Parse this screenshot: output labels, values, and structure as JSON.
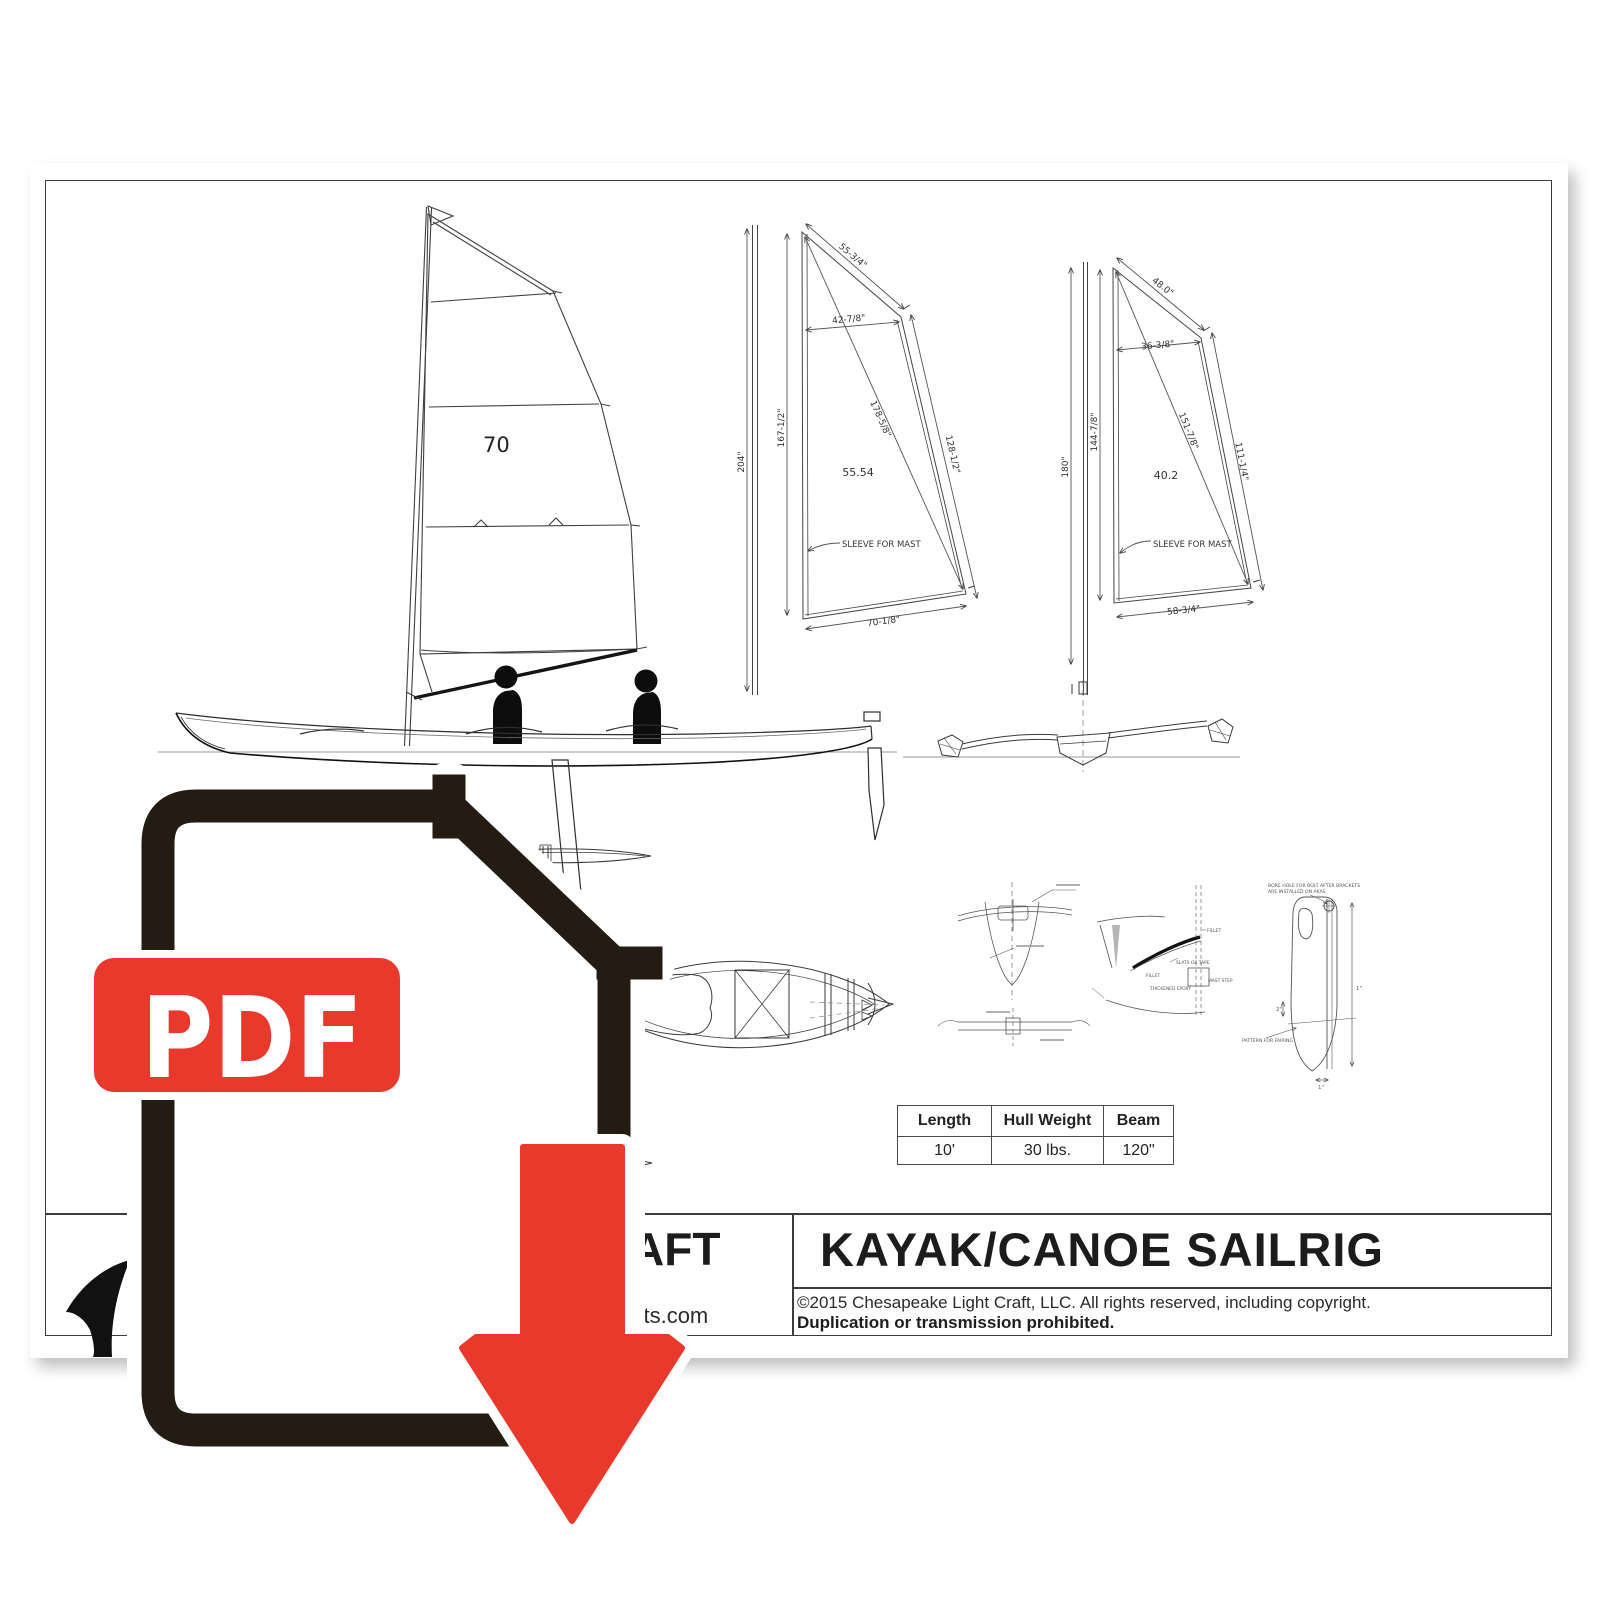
{
  "colors": {
    "red": "#e8392c",
    "icon_dark": "#241b13"
  },
  "overlay": {
    "pdf_label": "PDF"
  },
  "title_block": {
    "title": "KAYAK/CANOE SAILRIG",
    "copyright_line1": "©2015 Chesapeake Light Craft, LLC.  All rights reserved, including copyright.",
    "copyright_line2": "Duplication or transmission prohibited.",
    "company_fragment": "AFT",
    "website_fragment": "oats.com"
  },
  "spec_table": {
    "headers": [
      "Length",
      "Hull Weight",
      "Beam"
    ],
    "values": [
      "10'",
      "30 lbs.",
      "120\""
    ]
  },
  "sail_plan": {
    "area_label": "70"
  },
  "pattern_large": {
    "mast": "204\"",
    "luff": "167-1/2\"",
    "head": "55-3/4\"",
    "head_width": "42-7/8\"",
    "diagonal": "178-5/8\"",
    "leech": "128-1/2\"",
    "foot": "70-1/8\"",
    "area": "55.54",
    "note": "SLEEVE FOR MAST"
  },
  "pattern_small": {
    "mast": "180\"",
    "luff": "144-7/8\"",
    "head": "48.0\"",
    "head_width": "36-3/8\"",
    "diagonal": "151-7/8\"",
    "leech": "111-1/4\"",
    "foot": "58-3/4\"",
    "area": "40.2",
    "note": "SLEEVE FOR MAST"
  },
  "details": {
    "leeboard_note1": "BORE HOLE FOR BOLT AFTER BRACKETS",
    "leeboard_note2": "ARE INSTALLED ON AKAS",
    "pattern_label": "PATTERN FOR FAIRING",
    "dim_top": "1\"",
    "dim_mid": "2\"",
    "dim_bottom": "1\"",
    "fillet_a": "FILLET",
    "fillet_b": "FILLET",
    "slats": "SLATS OR TAPE",
    "epoxy": "THICKENED EPOXY",
    "mast_step": "MAST STEP"
  }
}
